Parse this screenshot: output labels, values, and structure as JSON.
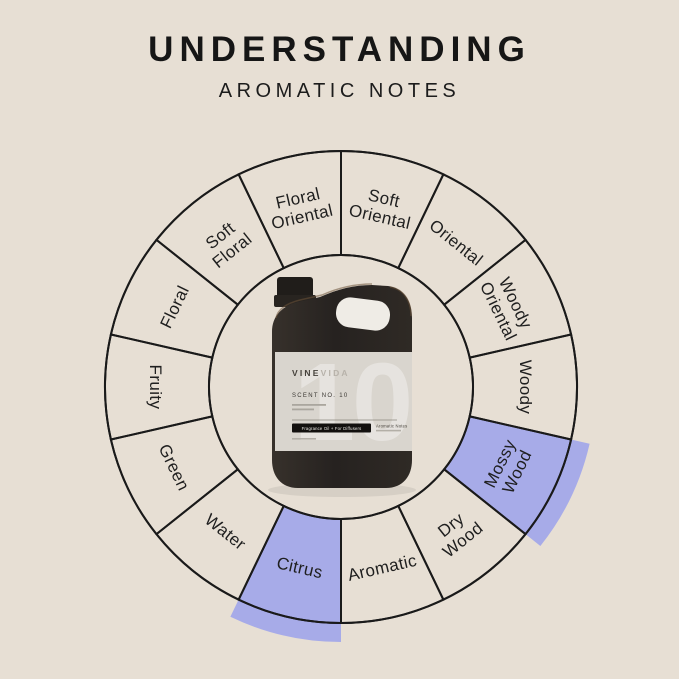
{
  "colors": {
    "background": "#e7dfd4",
    "highlight": "#a7abe8",
    "line": "#1a1a1a",
    "text": "#1f1f1f",
    "bottle_body": "#2b2723",
    "bottle_label": "#d9d5ce"
  },
  "header": {
    "title": "UNDERSTANDING",
    "subtitle": "AROMATIC NOTES"
  },
  "wheel": {
    "segments": [
      {
        "label": "Soft Oriental",
        "lines": [
          "Soft",
          "Oriental"
        ],
        "highlighted": false
      },
      {
        "label": "Oriental",
        "lines": [
          "Oriental"
        ],
        "highlighted": false
      },
      {
        "label": "Woody Oriental",
        "lines": [
          "Woody",
          "Oriental"
        ],
        "highlighted": false
      },
      {
        "label": "Woody",
        "lines": [
          "Woody"
        ],
        "highlighted": false
      },
      {
        "label": "Mossy Wood",
        "lines": [
          "Mossy",
          "Wood"
        ],
        "highlighted": true
      },
      {
        "label": "Dry Wood",
        "lines": [
          "Dry",
          "Wood"
        ],
        "highlighted": false
      },
      {
        "label": "Aromatic",
        "lines": [
          "Aromatic"
        ],
        "highlighted": false
      },
      {
        "label": "Citrus",
        "lines": [
          "Citrus"
        ],
        "highlighted": true
      },
      {
        "label": "Water",
        "lines": [
          "Water"
        ],
        "highlighted": false
      },
      {
        "label": "Green",
        "lines": [
          "Green"
        ],
        "highlighted": false
      },
      {
        "label": "Fruity",
        "lines": [
          "Fruity"
        ],
        "highlighted": false
      },
      {
        "label": "Floral",
        "lines": [
          "Floral"
        ],
        "highlighted": false
      },
      {
        "label": "Soft Floral",
        "lines": [
          "Soft",
          "Floral"
        ],
        "highlighted": false
      },
      {
        "label": "Floral Oriental",
        "lines": [
          "Floral",
          "Oriental"
        ],
        "highlighted": false
      }
    ]
  },
  "bottle": {
    "brand_vine": "VINE",
    "brand_vida": "VIDA",
    "watermark": "10",
    "scent_no": "SCENT NO. 10",
    "badge": "Fragrance Oil + For Diffusers",
    "notes": "Aromatic Notes"
  }
}
